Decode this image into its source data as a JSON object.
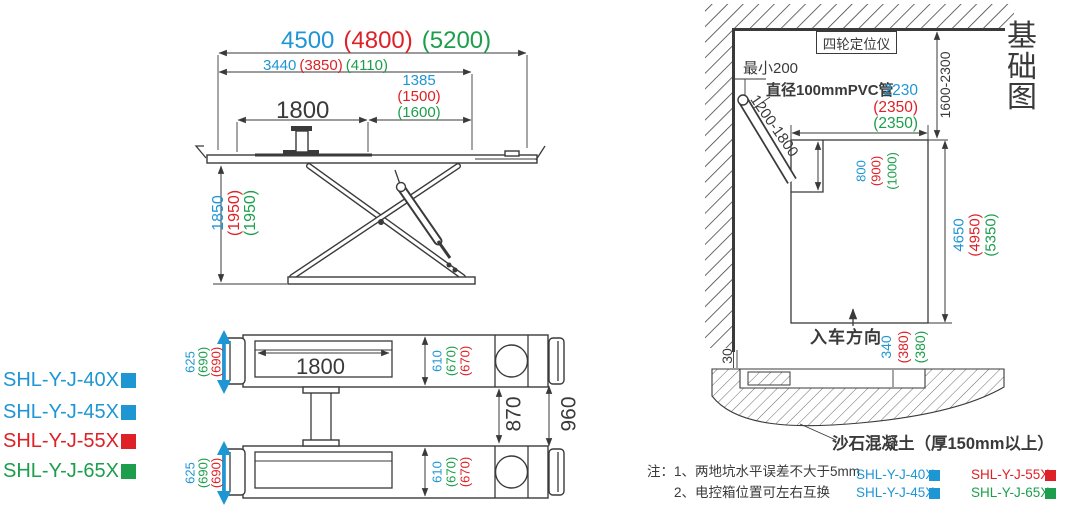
{
  "colors": {
    "blue": "#1f96d4",
    "red": "#de2126",
    "green": "#1c9e4c"
  },
  "side_view": {
    "total_length": {
      "blue": "4500",
      "red": "(4800)",
      "green": "(5200)"
    },
    "frame_length": {
      "blue": "3440",
      "red": "(3850)",
      "green": "(4110)"
    },
    "platform_span": "1800",
    "front_length": {
      "blue": "1385",
      "red": "(1500)",
      "green": "(1600)"
    },
    "lift_height": {
      "blue": "1850",
      "red": "(1950)",
      "green": "(1950)"
    }
  },
  "plan_view": {
    "runway_length": "1800",
    "outer_width": {
      "blue": "625",
      "green": "(690)",
      "red": "(690)"
    },
    "runway_width": {
      "blue": "610",
      "green": "(670)",
      "red": "(670)"
    },
    "inner_gap": "870",
    "outer_gap": "960"
  },
  "legend_left": [
    {
      "label": "SHL-Y-J-40X",
      "color": "blue"
    },
    {
      "label": "SHL-Y-J-45X",
      "color": "blue"
    },
    {
      "label": "SHL-Y-J-55X",
      "color": "red"
    },
    {
      "label": "SHL-Y-J-65X",
      "color": "green"
    }
  ],
  "foundation": {
    "title": "基础图",
    "aligner_label": "四轮定位仪",
    "min_clearance": "最小200",
    "pvc_label": "直径100mmPVC管",
    "pipe_range": "1200-1800",
    "wall_to_pit": "1600-2300",
    "pit_width": {
      "blue": "2230",
      "red": "(2350)",
      "green": "(2350)"
    },
    "notch_size": {
      "blue": "800",
      "red": "(900)",
      "green": "(1000)"
    },
    "pit_length": {
      "blue": "4650",
      "red": "(4950)",
      "green": "(5350)"
    },
    "pit_depth": {
      "blue": "340",
      "red": "(380)",
      "green": "(380)"
    },
    "edge_offset": "30",
    "drive_direction": "入车方向",
    "concrete_label": "沙石混凝土（厚150mm以上）",
    "notes": [
      "注：1、两地坑水平误差不大于5mm",
      "2、电控箱位置可左右互换"
    ],
    "legend": [
      {
        "label": "SHL-Y-J-40X",
        "color": "blue"
      },
      {
        "label": "SHL-Y-J-55X",
        "color": "red"
      },
      {
        "label": "SHL-Y-J-45X",
        "color": "blue"
      },
      {
        "label": "SHL-Y-J-65X",
        "color": "green"
      }
    ]
  }
}
